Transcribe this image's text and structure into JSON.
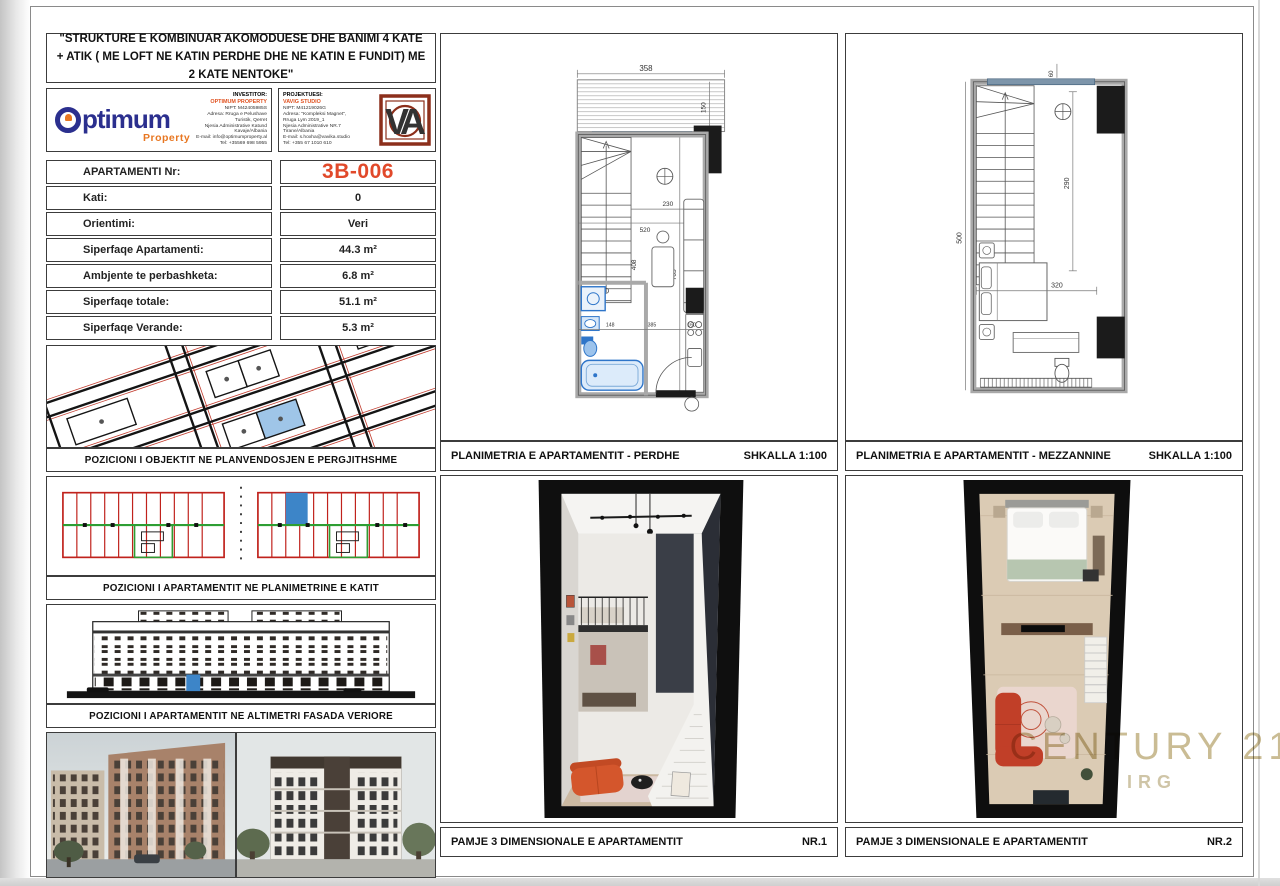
{
  "sheet_title": "\"STRUKTURE E KOMBINUAR AKOMODUESE DHE BANIMI 4 KATE + ATIK ( ME LOFT NE KATIN PERDHE DHE NE KATIN E FUNDIT) ME 2 KATE NENTOKE\"",
  "branding": {
    "optimum": {
      "wordmark": "ptimum",
      "sub": "Property"
    },
    "investor": {
      "header": "INVESTITOR:",
      "company": "OPTIMUM PROPERTY",
      "lines": [
        "NIPT: M42405985S",
        "Adresa: Rruga e Pelushave",
        "Turistik, Qerret",
        "Njesia Administrative Katund",
        "Kavaje/Albania",
        "E-mail: info@optimumproperty.al",
        "Tel: +35569 698 5955"
      ]
    },
    "designer": {
      "header": "PROJEKTUESI:",
      "company": "VAVIG STUDIO",
      "lines": [
        "NIPT: M41219026G",
        "Adresa: \"Kompleksi Magnet\",",
        "Rruga Lym 2019_1",
        "Njesia Administrative NR.7",
        "Tirane/Albania",
        "E-mail: s.hoxha@vavika.studio",
        "Tel: +355 67 1010 610"
      ]
    },
    "va_monogram": "VA"
  },
  "apartment_table": {
    "rows": [
      {
        "label": "APARTAMENTI Nr:",
        "value": "3B-006"
      },
      {
        "label": "Kati:",
        "value": "0"
      },
      {
        "label": "Orientimi:",
        "value": "Veri"
      },
      {
        "label": "Siperfaqe Apartamenti:",
        "value": "44.3 m²"
      },
      {
        "label": "Ambjente te perbashketa:",
        "value": "6.8 m²"
      },
      {
        "label": "Siperfaqe totale:",
        "value": "51.1 m²"
      },
      {
        "label": "Siperfaqe Verande:",
        "value": "5.3 m²"
      }
    ]
  },
  "panels": {
    "site": {
      "caption": "POZICIONI I OBJEKTIT NE PLANVENDOSJEN E PERGJITHSHME"
    },
    "floorplate": {
      "caption": "POZICIONI I APARTAMENTIT  NE PLANIMETRINE E KATIT"
    },
    "elevation": {
      "caption": "POZICIONI I APARTAMENTIT NE ALTIMETRI  FASADA VERIORE"
    },
    "plan_ground": {
      "caption": "PLANIMETRIA E APARTAMENTIT - PERDHE",
      "scale": "SHKALLA 1:100"
    },
    "plan_mezz": {
      "caption": "PLANIMETRIA E APARTAMENTIT - MEZZANNINE",
      "scale": "SHKALLA 1:100"
    },
    "view1": {
      "caption": "PAMJE 3 DIMENSIONALE E APARTAMENTIT",
      "nr": "NR.1"
    },
    "view2": {
      "caption": "PAMJE 3 DIMENSIONALE E APARTAMENTIT",
      "nr": "NR.2"
    }
  },
  "plans": {
    "perdhe": {
      "dims": [
        "358",
        "150",
        "60",
        "230",
        "408",
        "520",
        "705",
        "148",
        "385",
        "160"
      ]
    },
    "mezzanine": {
      "dims": [
        "60",
        "290",
        "320",
        "500"
      ]
    }
  },
  "watermark": {
    "brand": "CENTURY 21",
    "sub": "IRG"
  },
  "colors": {
    "accent_orange": "#e1492a",
    "navy": "#2b2f8e",
    "maroon": "#8c2f1b",
    "plan_red": "#c0221c",
    "plan_green": "#2e9e33",
    "highlight_blue": "#3d85c8",
    "fixture_blue": "#2e75c9",
    "watermark_gold": "#c7b98e"
  }
}
